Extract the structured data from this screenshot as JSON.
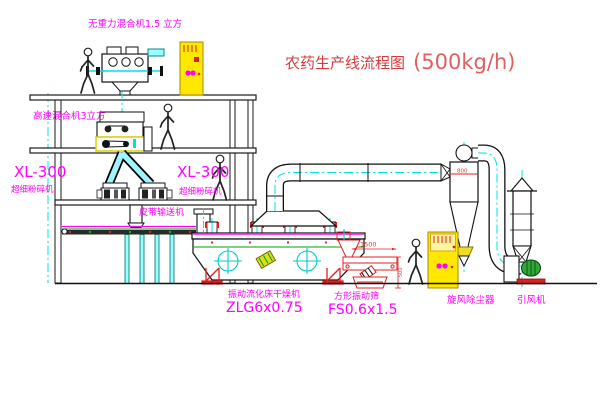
{
  "title": {
    "name": "农药生产线流程图",
    "capacity": "(500kg/h)"
  },
  "labels": {
    "gravity_free_mixer": "无重力混合机1.5 立方",
    "high_speed_mixer": "高速混合机3立方",
    "pulverizer_left_model": "XL-300",
    "pulverizer_left_name": "超细粉碎机",
    "pulverizer_center_model": "XL-300",
    "pulverizer_center_name": "超细粉碎机",
    "belt_conveyor": "皮带输送机",
    "dryer_name": "振动流化床干燥机",
    "dryer_model": "ZLG6x0.75",
    "screen_name": "方形振动筛",
    "screen_model": "FS0.6x1.5",
    "cyclone": "旋风除尘器",
    "fan": "引风机"
  },
  "dims": {
    "screen_length": "1500",
    "cyclone_note": "800",
    "screen_height": "500"
  },
  "colors": {
    "label_magenta": "#FF00FF",
    "title_red": "#D43C3C",
    "line_black": "#1A1A1A",
    "flow_cyan": "#00E0E0",
    "cabinet_yellow": "#FFE800",
    "machine_red": "#E02020",
    "belt_green": "#00A000",
    "background": "#FFFFFF"
  }
}
